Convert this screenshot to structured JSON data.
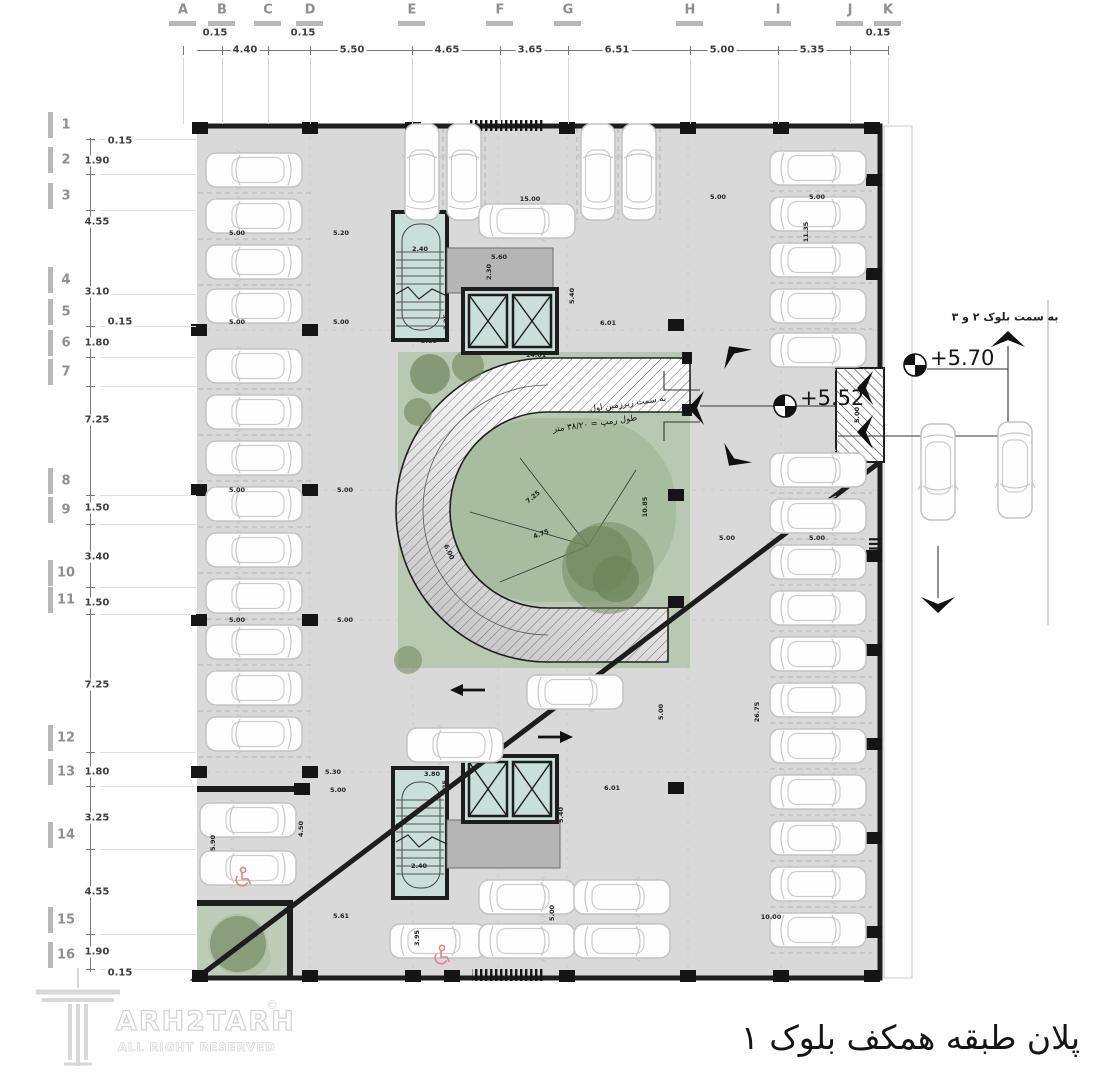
{
  "colors": {
    "floor": "#d9d9d9",
    "wall": "#1d1d1d",
    "core": "#c9dfd9",
    "lobby": "#b5b5b5",
    "green": "#b9c9b1",
    "green_inner": "#a8bc9f",
    "tree": "#6f855c",
    "handicap": "#e08585",
    "grid_label": "#8f8f8f",
    "hatch": "#666666"
  },
  "grid_top": {
    "labels": [
      {
        "t": "A",
        "x": 183
      },
      {
        "t": "B",
        "x": 222
      },
      {
        "t": "C",
        "x": 268
      },
      {
        "t": "D",
        "x": 310
      },
      {
        "t": "E",
        "x": 412
      },
      {
        "t": "F",
        "x": 500
      },
      {
        "t": "G",
        "x": 568
      },
      {
        "t": "H",
        "x": 690
      },
      {
        "t": "I",
        "x": 778
      },
      {
        "t": "J",
        "x": 850
      },
      {
        "t": "K",
        "x": 888
      }
    ],
    "dims": [
      {
        "t": "0.15",
        "x": 215,
        "y": 33
      },
      {
        "t": "4.40",
        "x": 245,
        "y": 50
      },
      {
        "t": "0.15",
        "x": 303,
        "y": 33
      },
      {
        "t": "5.50",
        "x": 352,
        "y": 50
      },
      {
        "t": "4.65",
        "x": 447,
        "y": 50
      },
      {
        "t": "3.65",
        "x": 530,
        "y": 50
      },
      {
        "t": "6.51",
        "x": 617,
        "y": 50
      },
      {
        "t": "5.00",
        "x": 722,
        "y": 50
      },
      {
        "t": "5.35",
        "x": 812,
        "y": 50
      },
      {
        "t": "0.15",
        "x": 878,
        "y": 33
      }
    ]
  },
  "grid_left": {
    "labels": [
      {
        "t": "1",
        "y": 125
      },
      {
        "t": "2",
        "y": 160
      },
      {
        "t": "3",
        "y": 196
      },
      {
        "t": "4",
        "y": 280
      },
      {
        "t": "5",
        "y": 312
      },
      {
        "t": "6",
        "y": 343
      },
      {
        "t": "7",
        "y": 372
      },
      {
        "t": "8",
        "y": 481
      },
      {
        "t": "9",
        "y": 510
      },
      {
        "t": "10",
        "y": 573
      },
      {
        "t": "11",
        "y": 600
      },
      {
        "t": "12",
        "y": 738
      },
      {
        "t": "13",
        "y": 772
      },
      {
        "t": "14",
        "y": 835
      },
      {
        "t": "15",
        "y": 920
      },
      {
        "t": "16",
        "y": 955
      }
    ],
    "dims": [
      {
        "t": "0.15",
        "x": 120,
        "y": 141
      },
      {
        "t": "1.90",
        "x": 97,
        "y": 161
      },
      {
        "t": "4.55",
        "x": 97,
        "y": 222
      },
      {
        "t": "3.10",
        "x": 97,
        "y": 292
      },
      {
        "t": "0.15",
        "x": 120,
        "y": 322
      },
      {
        "t": "1.80",
        "x": 97,
        "y": 343
      },
      {
        "t": "7.25",
        "x": 97,
        "y": 420
      },
      {
        "t": "1.50",
        "x": 97,
        "y": 508
      },
      {
        "t": "3.40",
        "x": 97,
        "y": 557
      },
      {
        "t": "1.50",
        "x": 97,
        "y": 603
      },
      {
        "t": "7.25",
        "x": 97,
        "y": 685
      },
      {
        "t": "1.80",
        "x": 97,
        "y": 772
      },
      {
        "t": "3.25",
        "x": 97,
        "y": 818
      },
      {
        "t": "4.55",
        "x": 97,
        "y": 892
      },
      {
        "t": "1.90",
        "x": 97,
        "y": 952
      },
      {
        "t": "0.15",
        "x": 120,
        "y": 973
      }
    ]
  },
  "plan_dimensions": [
    {
      "t": "5.00",
      "x": 237,
      "y": 233
    },
    {
      "t": "5.20",
      "x": 341,
      "y": 233
    },
    {
      "t": "2.40",
      "x": 420,
      "y": 249
    },
    {
      "t": "5.60",
      "x": 499,
      "y": 257
    },
    {
      "t": "2.30",
      "x": 489,
      "y": 272,
      "r": -90
    },
    {
      "t": "15.00",
      "x": 530,
      "y": 199
    },
    {
      "t": "5.00",
      "x": 718,
      "y": 197
    },
    {
      "t": "5.00",
      "x": 817,
      "y": 197
    },
    {
      "t": "11.35",
      "x": 806,
      "y": 232,
      "r": -90
    },
    {
      "t": "2.25",
      "x": 446,
      "y": 322,
      "r": -90
    },
    {
      "t": "3.80",
      "x": 429,
      "y": 341
    },
    {
      "t": "5.40",
      "x": 572,
      "y": 296,
      "r": -90
    },
    {
      "t": "6.01",
      "x": 608,
      "y": 323
    },
    {
      "t": "14.01",
      "x": 536,
      "y": 355
    },
    {
      "t": "5.00",
      "x": 237,
      "y": 322
    },
    {
      "t": "5.00",
      "x": 341,
      "y": 322
    },
    {
      "t": "5.00",
      "x": 237,
      "y": 490
    },
    {
      "t": "5.00",
      "x": 345,
      "y": 490
    },
    {
      "t": "5.00",
      "x": 237,
      "y": 620
    },
    {
      "t": "5.00",
      "x": 345,
      "y": 620
    },
    {
      "t": "5.00",
      "x": 727,
      "y": 538
    },
    {
      "t": "5.00",
      "x": 817,
      "y": 538
    },
    {
      "t": "7.25",
      "x": 533,
      "y": 497,
      "r": -40
    },
    {
      "t": "4.75",
      "x": 541,
      "y": 534,
      "r": -20
    },
    {
      "t": "6.00",
      "x": 449,
      "y": 552,
      "r": 65
    },
    {
      "t": "10.85",
      "x": 645,
      "y": 507,
      "r": -90
    },
    {
      "t": "5.00",
      "x": 857,
      "y": 415,
      "r": -90
    },
    {
      "t": "26.75",
      "x": 757,
      "y": 712,
      "r": -90
    },
    {
      "t": "5.00",
      "x": 661,
      "y": 712,
      "r": -90
    },
    {
      "t": "10.00",
      "x": 771,
      "y": 917
    },
    {
      "t": "5.30",
      "x": 333,
      "y": 772
    },
    {
      "t": "3.80",
      "x": 432,
      "y": 774
    },
    {
      "t": "2.25",
      "x": 445,
      "y": 788,
      "r": -90
    },
    {
      "t": "6.01",
      "x": 612,
      "y": 788
    },
    {
      "t": "5.40",
      "x": 561,
      "y": 815,
      "r": -90
    },
    {
      "t": "2.40",
      "x": 419,
      "y": 866
    },
    {
      "t": "5.00",
      "x": 338,
      "y": 790
    },
    {
      "t": "4.50",
      "x": 301,
      "y": 829,
      "r": -90
    },
    {
      "t": "5.90",
      "x": 213,
      "y": 843,
      "r": -90
    },
    {
      "t": "5.61",
      "x": 341,
      "y": 916
    },
    {
      "t": "3.95",
      "x": 417,
      "y": 938,
      "r": -90
    },
    {
      "t": "5.00",
      "x": 552,
      "y": 913,
      "r": -90
    }
  ],
  "levels": {
    "upper": "+5.70",
    "lower": "+5.52"
  },
  "ramp": {
    "line1": "به سمت زیرزمین اول",
    "line2": "طول رمپ = ۳۸/۲۰ متر"
  },
  "site": {
    "to_blocks": "به سمت بلوک ۲ و ۳"
  },
  "title": {
    "fa": "پلان طبقه همکف بلوک ۱"
  },
  "logo": {
    "brand": "ARH2TARH",
    "tagline": "ALL RIGHT RESERVED",
    "mark": "©"
  },
  "cars": [
    {
      "x": 254,
      "y": 170,
      "d": "l"
    },
    {
      "x": 254,
      "y": 216,
      "d": "l"
    },
    {
      "x": 254,
      "y": 262,
      "d": "l"
    },
    {
      "x": 254,
      "y": 306,
      "d": "l"
    },
    {
      "x": 254,
      "y": 366,
      "d": "l"
    },
    {
      "x": 254,
      "y": 412,
      "d": "l"
    },
    {
      "x": 254,
      "y": 458,
      "d": "l"
    },
    {
      "x": 254,
      "y": 504,
      "d": "l"
    },
    {
      "x": 254,
      "y": 550,
      "d": "l"
    },
    {
      "x": 254,
      "y": 596,
      "d": "l"
    },
    {
      "x": 254,
      "y": 642,
      "d": "l"
    },
    {
      "x": 254,
      "y": 688,
      "d": "l"
    },
    {
      "x": 254,
      "y": 734,
      "d": "l"
    },
    {
      "x": 248,
      "y": 820,
      "d": "l"
    },
    {
      "x": 248,
      "y": 868,
      "d": "l"
    },
    {
      "x": 422,
      "y": 172,
      "d": "u"
    },
    {
      "x": 464,
      "y": 172,
      "d": "u"
    },
    {
      "x": 598,
      "y": 172,
      "d": "u"
    },
    {
      "x": 639,
      "y": 172,
      "d": "u"
    },
    {
      "x": 527,
      "y": 221,
      "d": "r"
    },
    {
      "x": 818,
      "y": 168,
      "d": "r"
    },
    {
      "x": 818,
      "y": 214,
      "d": "r"
    },
    {
      "x": 818,
      "y": 260,
      "d": "r"
    },
    {
      "x": 818,
      "y": 306,
      "d": "r"
    },
    {
      "x": 818,
      "y": 350,
      "d": "r"
    },
    {
      "x": 818,
      "y": 470,
      "d": "r"
    },
    {
      "x": 818,
      "y": 516,
      "d": "r"
    },
    {
      "x": 818,
      "y": 562,
      "d": "r"
    },
    {
      "x": 818,
      "y": 608,
      "d": "r"
    },
    {
      "x": 818,
      "y": 654,
      "d": "r"
    },
    {
      "x": 818,
      "y": 700,
      "d": "r"
    },
    {
      "x": 818,
      "y": 746,
      "d": "r"
    },
    {
      "x": 818,
      "y": 792,
      "d": "r"
    },
    {
      "x": 818,
      "y": 838,
      "d": "r"
    },
    {
      "x": 818,
      "y": 884,
      "d": "r"
    },
    {
      "x": 818,
      "y": 930,
      "d": "r"
    },
    {
      "x": 527,
      "y": 897,
      "d": "r"
    },
    {
      "x": 622,
      "y": 897,
      "d": "r"
    },
    {
      "x": 438,
      "y": 941,
      "d": "r"
    },
    {
      "x": 527,
      "y": 941,
      "d": "r"
    },
    {
      "x": 622,
      "y": 941,
      "d": "r"
    },
    {
      "x": 575,
      "y": 692,
      "d": "r"
    },
    {
      "x": 455,
      "y": 745,
      "d": "l"
    },
    {
      "x": 938,
      "y": 472,
      "d": "dn"
    },
    {
      "x": 1015,
      "y": 470,
      "d": "dn"
    }
  ],
  "wheelchairs": [
    {
      "x": 243,
      "y": 877
    },
    {
      "x": 442,
      "y": 955
    }
  ],
  "columns": [
    {
      "x": 200,
      "y": 128
    },
    {
      "x": 310,
      "y": 128
    },
    {
      "x": 413,
      "y": 128
    },
    {
      "x": 567,
      "y": 128
    },
    {
      "x": 688,
      "y": 128
    },
    {
      "x": 781,
      "y": 128
    },
    {
      "x": 872,
      "y": 128
    },
    {
      "x": 200,
      "y": 976
    },
    {
      "x": 310,
      "y": 976
    },
    {
      "x": 413,
      "y": 976
    },
    {
      "x": 452,
      "y": 976
    },
    {
      "x": 567,
      "y": 976
    },
    {
      "x": 688,
      "y": 976
    },
    {
      "x": 781,
      "y": 976
    },
    {
      "x": 872,
      "y": 976
    },
    {
      "x": 199,
      "y": 330
    },
    {
      "x": 199,
      "y": 490
    },
    {
      "x": 199,
      "y": 620
    },
    {
      "x": 199,
      "y": 772
    },
    {
      "x": 874,
      "y": 180
    },
    {
      "x": 874,
      "y": 274
    },
    {
      "x": 874,
      "y": 556
    },
    {
      "x": 874,
      "y": 650
    },
    {
      "x": 874,
      "y": 744
    },
    {
      "x": 874,
      "y": 838
    },
    {
      "x": 874,
      "y": 932
    },
    {
      "x": 310,
      "y": 330
    },
    {
      "x": 310,
      "y": 490
    },
    {
      "x": 310,
      "y": 620
    },
    {
      "x": 310,
      "y": 772
    },
    {
      "x": 676,
      "y": 325
    },
    {
      "x": 676,
      "y": 495
    },
    {
      "x": 676,
      "y": 602
    },
    {
      "x": 676,
      "y": 788
    },
    {
      "x": 302,
      "y": 789
    }
  ],
  "arrows": [
    {
      "x": 1008,
      "y": 338,
      "r": 0,
      "k": "chev"
    },
    {
      "x": 938,
      "y": 606,
      "r": 180,
      "k": "chev"
    },
    {
      "x": 733,
      "y": 352,
      "r": -35,
      "k": "chev"
    },
    {
      "x": 733,
      "y": 460,
      "r": 215,
      "k": "chev"
    },
    {
      "x": 695,
      "y": 408,
      "r": -90,
      "k": "chev"
    },
    {
      "x": 864,
      "y": 388,
      "r": -90,
      "k": "chev"
    },
    {
      "x": 864,
      "y": 432,
      "r": -90,
      "k": "chev"
    },
    {
      "x": 467,
      "y": 690,
      "r": 180,
      "k": "flat"
    },
    {
      "x": 556,
      "y": 737,
      "r": 0,
      "k": "flat"
    }
  ]
}
